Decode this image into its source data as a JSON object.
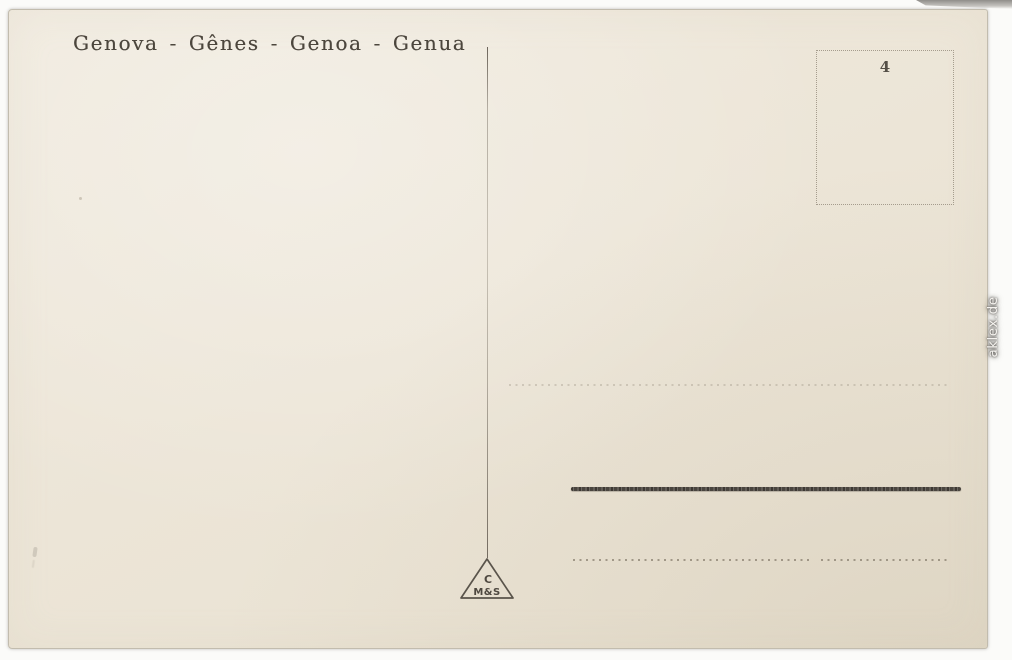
{
  "scan": {
    "watermark": "aklex.de",
    "background_color": "#fbfbf9"
  },
  "postcard": {
    "title": "Genova - Gênes - Genoa - Genua",
    "paper_color": "#ece5d7",
    "title_color": "#4c463d",
    "heavy_rule_color": "#57524b",
    "stamp_box": {
      "number": "4"
    },
    "publisher_mark": {
      "top": "C",
      "bottom": "M&S"
    }
  }
}
